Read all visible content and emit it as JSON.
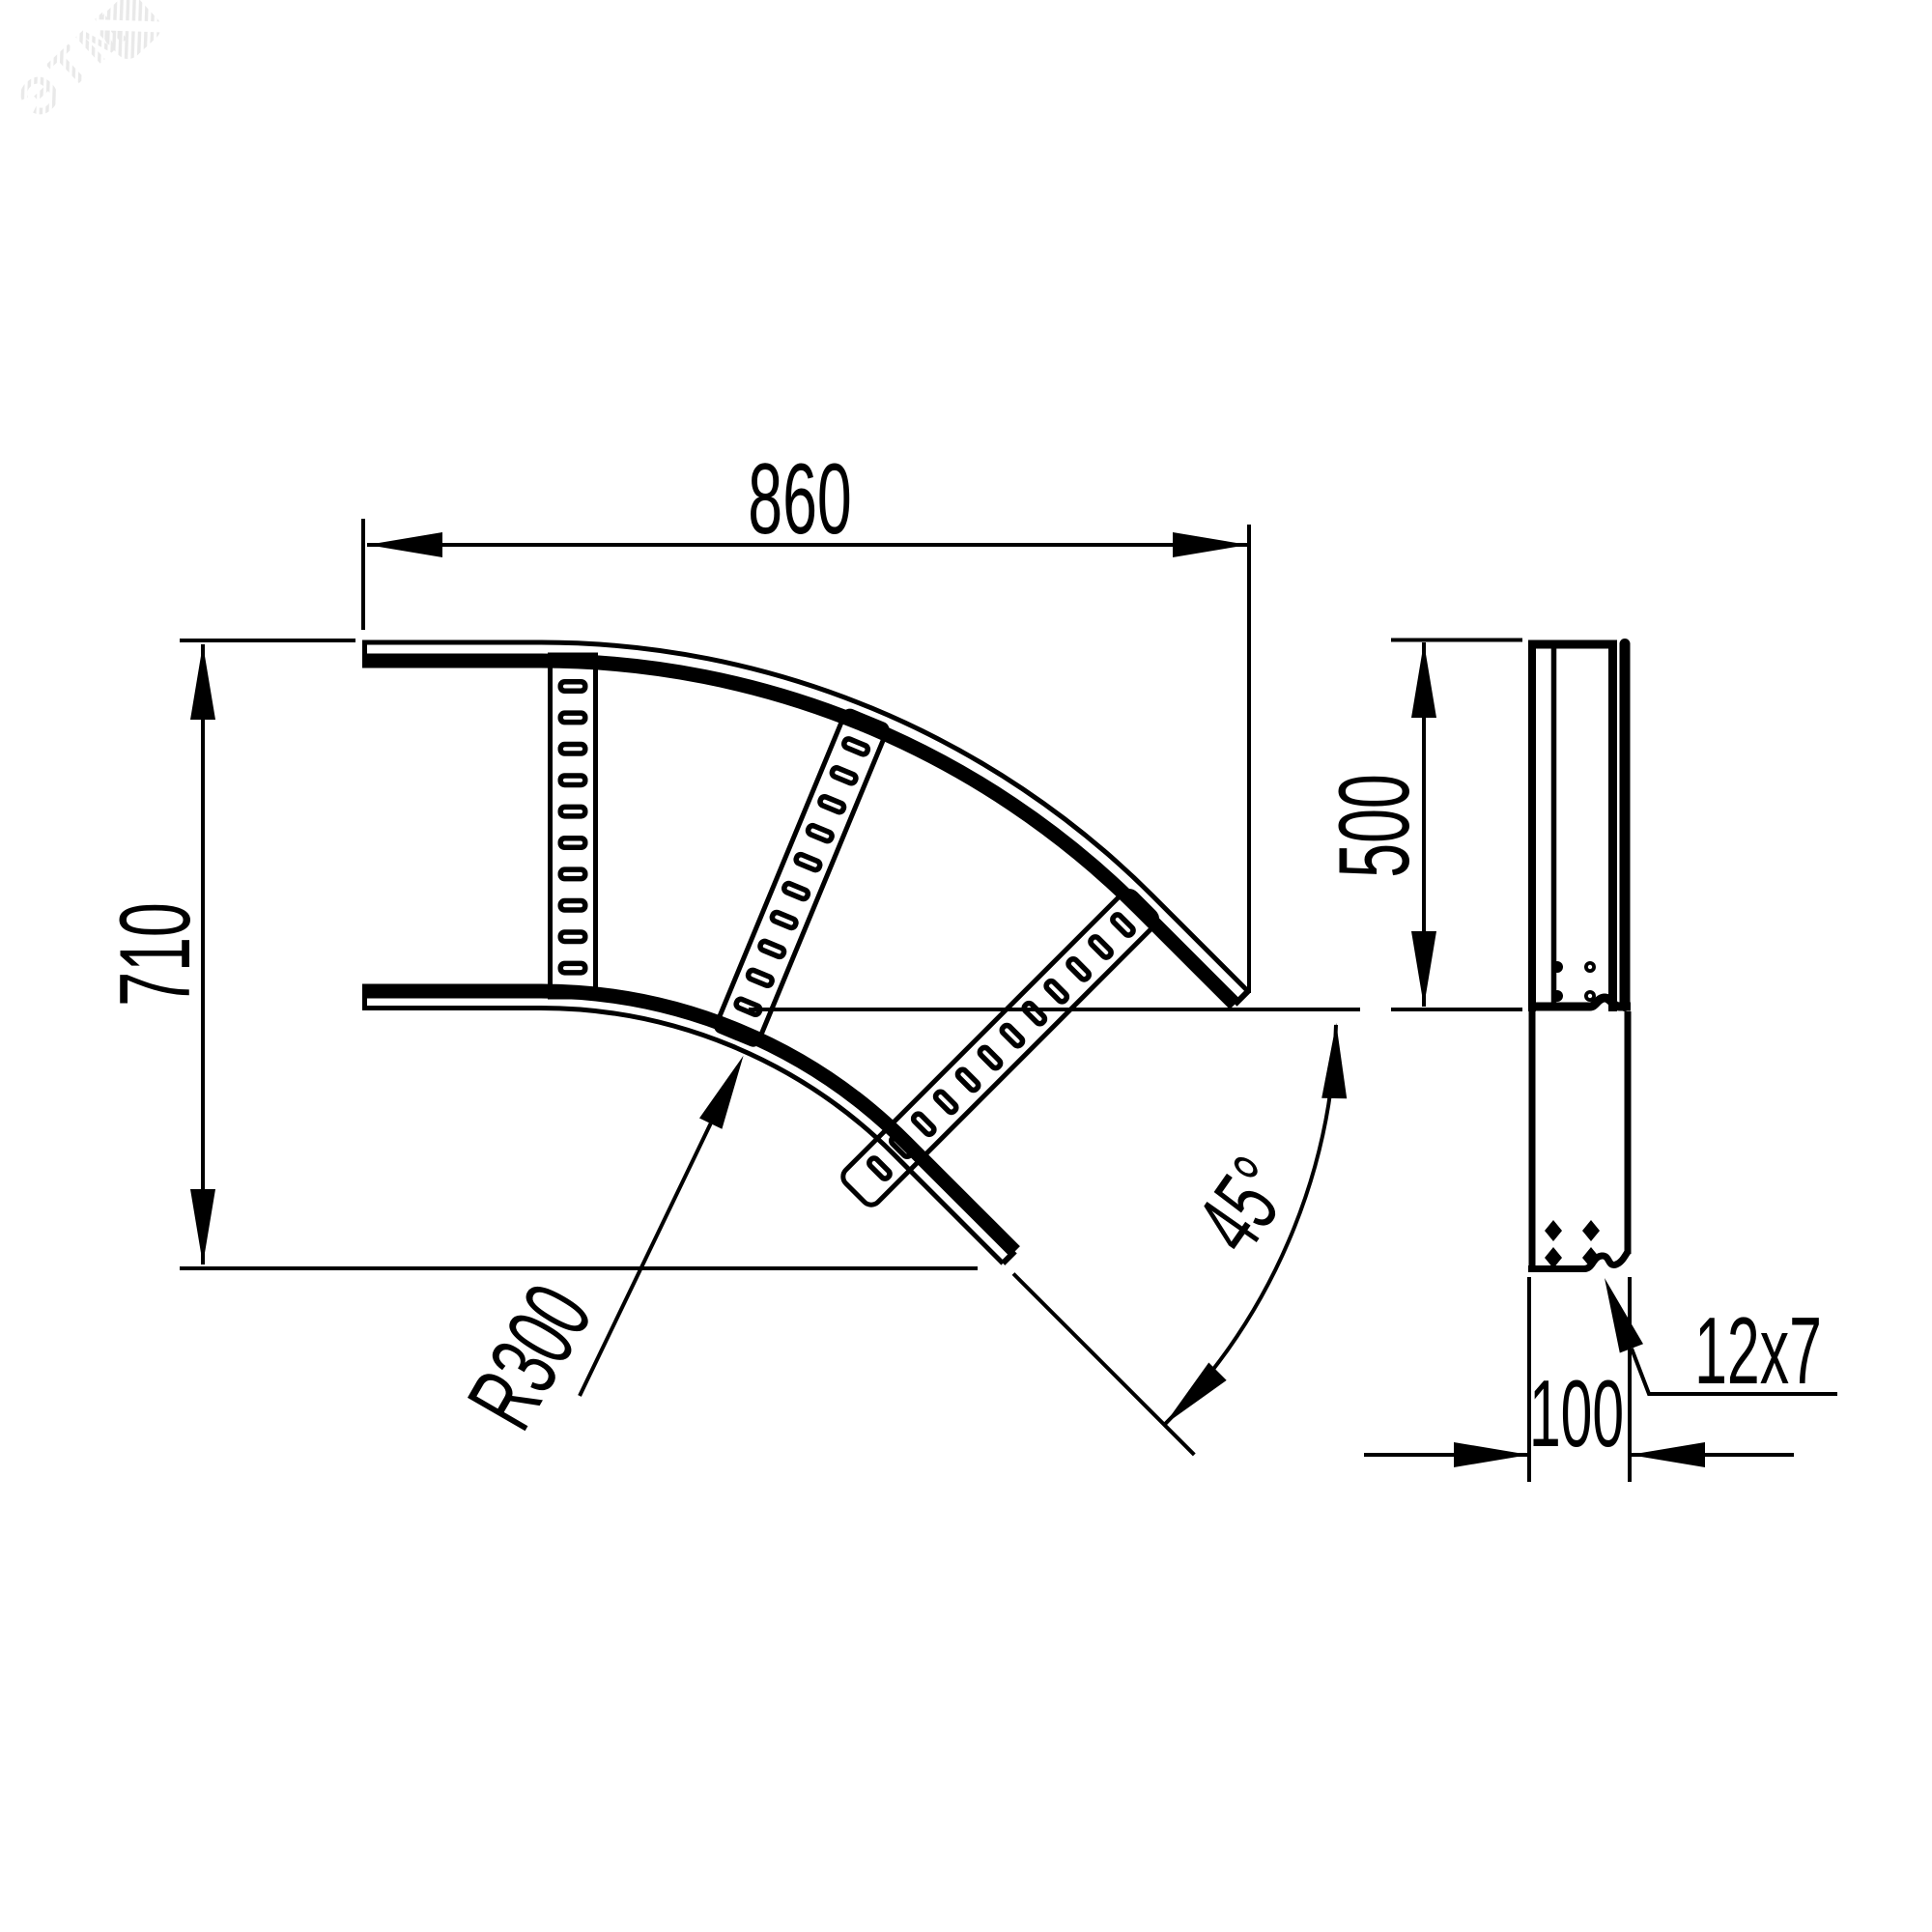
{
  "page": {
    "background": "#ffffff",
    "ink": "#000000",
    "description": "Technical drawing of a 45-degree cable ladder horizontal bend, plan view and side view"
  },
  "watermark": {
    "text": "ЭТМ",
    "color": "#e9e9e9"
  },
  "views": {
    "plan": {
      "dim_width": "860",
      "dim_height": "710",
      "dim_radius": "R300",
      "dim_angle": "45°"
    },
    "side": {
      "dim_height": "500",
      "dim_width": "100",
      "dim_slot": "12x7"
    }
  }
}
